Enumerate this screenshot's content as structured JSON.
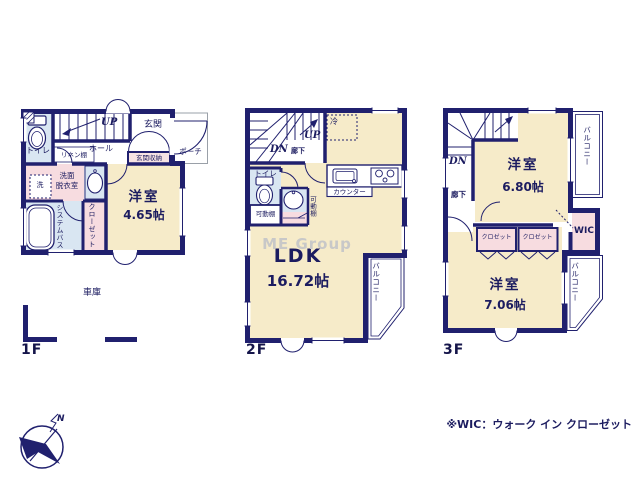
{
  "colors": {
    "wall": "#20206e",
    "room_beige": "#f6ebc9",
    "wet_blue": "#d9e6f2",
    "closet_pink": "#f7dce0",
    "storage_pink": "#f6e3e3",
    "text_navy": "#1c1c60",
    "watermark_gray": "#c8c8c8"
  },
  "floor1": {
    "floor_label": "1F",
    "toilet": "トイレ",
    "stairs_up": "UP",
    "entrance": "玄関",
    "porch": "ポーチ",
    "entrance_storage": "玄関収納",
    "hall": "ホール",
    "linen_shelf": "リネン棚",
    "washer": "洗",
    "washroom_line1": "洗面",
    "washroom_line2": "脱衣室",
    "system_bath": "システムバス",
    "closet": "クローゼット",
    "western_room": "洋室",
    "western_room_size": "4.65帖",
    "garage": "車庫"
  },
  "floor2": {
    "floor_label": "2F",
    "stairs_up": "UP",
    "stairs_down": "DN",
    "corridor": "廊下",
    "refrigerator": "冷",
    "toilet": "トイレ",
    "counter": "カウンター",
    "movable_shelf_box": "可動棚",
    "movable_shelf_vertical": "可動棚",
    "ldk": "LDK",
    "ldk_size": "16.72帖",
    "balcony": "バルコニー",
    "watermark": "ME Group"
  },
  "floor3": {
    "floor_label": "3F",
    "stairs_down": "DN",
    "corridor": "廊下",
    "western_room_upper": "洋室",
    "western_room_upper_size": "6.80帖",
    "balcony_upper": "バルコニー",
    "closet_left": "クロゼット",
    "closet_right": "クロゼット",
    "wic": "WIC",
    "western_room_lower": "洋室",
    "western_room_lower_size": "7.06帖",
    "balcony_lower": "バルコニー"
  },
  "footer": {
    "note": "※WIC：ウォーク イン クローゼット",
    "compass_north": "N"
  }
}
